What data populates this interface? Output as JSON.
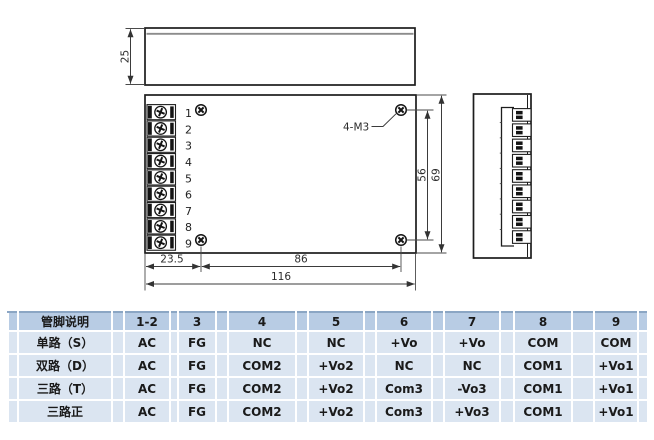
{
  "drawing": {
    "dims": {
      "top_height": "25",
      "hole_pitch_v": "56",
      "overall_height": "69",
      "edge_to_hole": "23.5",
      "hole_pitch_h": "86",
      "overall_width": "116"
    },
    "mount_hole_label": "4-M3",
    "terminal_numbers": [
      "1",
      "2",
      "3",
      "4",
      "5",
      "6",
      "7",
      "8",
      "9"
    ]
  },
  "table": {
    "header": [
      "管脚说明",
      "1-2",
      "3",
      "4",
      "5",
      "6",
      "7",
      "8",
      "9"
    ],
    "rows": [
      {
        "label": "单路（S）",
        "cells": [
          "AC",
          "FG",
          "NC",
          "NC",
          "+Vo",
          "+Vo",
          "COM",
          "COM"
        ]
      },
      {
        "label": "双路（D）",
        "cells": [
          "AC",
          "FG",
          "COM2",
          "+Vo2",
          "NC",
          "NC",
          "COM1",
          "+Vo1"
        ]
      },
      {
        "label": "三路（T）",
        "cells": [
          "AC",
          "FG",
          "COM2",
          "+Vo2",
          "Com3",
          "-Vo3",
          "COM1",
          "+Vo1"
        ]
      },
      {
        "label": "三路正",
        "cells": [
          "AC",
          "FG",
          "COM2",
          "+Vo2",
          "Com3",
          "+Vo3",
          "COM1",
          "+Vo1"
        ]
      }
    ]
  },
  "colors": {
    "table_header_bg": "#b8cce4",
    "table_row_bg": "#dbe5f1",
    "table_border": "#ffffff",
    "header_top_border": "#8ba6c4",
    "drawing_line": "#1d1d1d"
  }
}
